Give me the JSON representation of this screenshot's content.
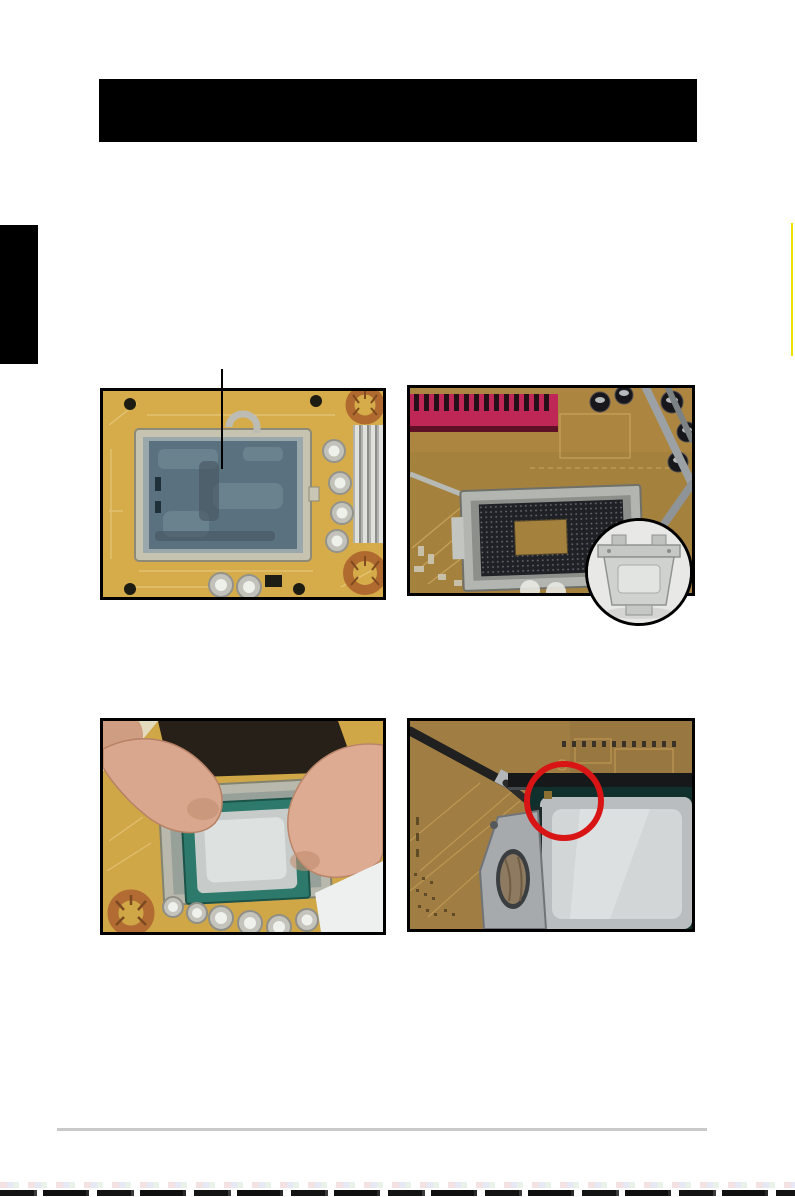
{
  "page": {
    "background": "#ffffff",
    "header_bar_color": "#000000",
    "side_tab_color": "#000000",
    "edge_highlight_color": "#ece400",
    "footer_rule_color": "#c9c9c9",
    "visible_text": []
  },
  "figures": {
    "socket_cap": {
      "label": "cpu-socket-with-protective-cap-photo",
      "board_color": "#d6ac4a",
      "cap_color": "#5a7180",
      "frame_color": "#c6c3b0",
      "callout_color": "#000000"
    },
    "socket_open": {
      "label": "cpu-socket-open-cap-removed-photo",
      "board_color": "#a5813e",
      "heatsink_color": "#bf2756",
      "pinfield_color": "#1f2126",
      "inset_bg_color": "#e8e9e6",
      "inset_cap_color": "#cfd2cf"
    },
    "cpu_insert": {
      "label": "hand-installing-cpu-photo",
      "board_color": "#d0a746",
      "cpu_pcb_color": "#2d7a6c",
      "cpu_lid_color": "#c7cccb",
      "skin_color": "#d8a78d"
    },
    "cpu_seated": {
      "label": "cpu-seated-alignment-key-photo",
      "board_color": "#997740",
      "cpu_lid_color": "#b9bdbf",
      "annotation_circle_color": "#d81414"
    }
  }
}
